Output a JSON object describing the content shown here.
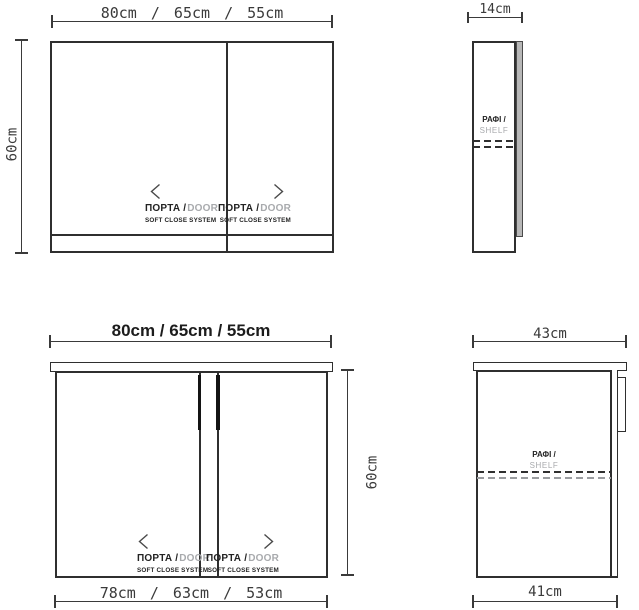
{
  "drawing": "kitchen cabinet dimension drawing",
  "palette": {
    "line_ink": "#2f2f2f",
    "dimension_ink": "#3a3a3a",
    "muted_text": "#a8aaad",
    "door_strip_fill": "#b7b7b7",
    "handle_fill": "#141414",
    "background": "#ffffff"
  },
  "icons": {
    "door_open_left": "chevron-left",
    "door_open_right": "chevron-right"
  },
  "labels": {
    "door_primary": "ΠΟΡΤΑ /",
    "door_secondary": "DOOR",
    "door_sub": "SOFT CLOSE SYSTEM",
    "shelf_primary": "ΡΑΦΙ /",
    "shelf_secondary": "SHELF"
  },
  "wall_cabinet": {
    "front": {
      "width_options": "80cm / 65cm / 55cm",
      "height": "60cm"
    },
    "side": {
      "depth": "14cm"
    }
  },
  "base_cabinet": {
    "front": {
      "width_options": "80cm / 65cm / 55cm",
      "bottom_width_options": "78cm / 63cm / 53cm",
      "height": "60cm"
    },
    "side": {
      "top_depth": "43cm",
      "bottom_depth": "41cm"
    }
  }
}
